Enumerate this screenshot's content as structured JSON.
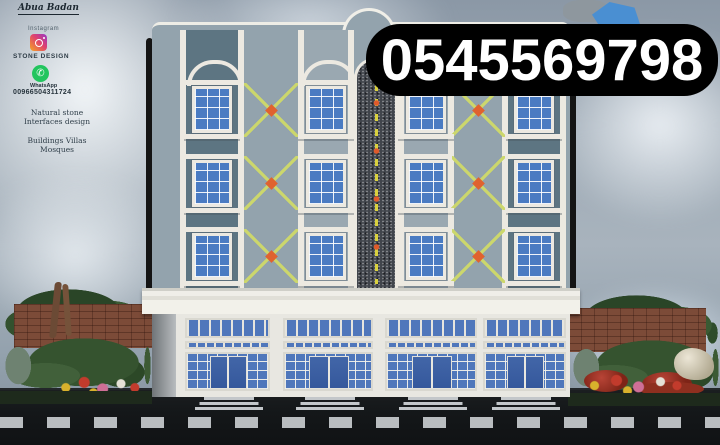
{
  "overlay": {
    "phone": "0545569798"
  },
  "sidebar": {
    "signature": "Abua Badan",
    "instagram_label": "Instagram",
    "instagram_handle": "STONE DESIGN",
    "whatsapp_label": "WhatsApp",
    "whatsapp_number": "00966504311724",
    "tagline_line1": "Natural stone",
    "tagline_line2": "Interfaces design",
    "services_line1": "Buildings Villas",
    "services_line2": "Mosques"
  },
  "icons": {
    "whatsapp_glyph": "✆"
  },
  "theme": {
    "facade-light": "#93a3ad",
    "facade-dark": "#5d7582",
    "glass": "#4a7bc2",
    "granite": "#41454c",
    "decor-yellow": "#ccd76c",
    "decor-orange": "#e0622f",
    "shop-glass": "#4f77bb",
    "door-blue": "#35589c",
    "curb": "#b9bdc0",
    "brick": "#7c4b38",
    "overlay-bg": "#000000",
    "overlay-text": "#ffffff"
  }
}
